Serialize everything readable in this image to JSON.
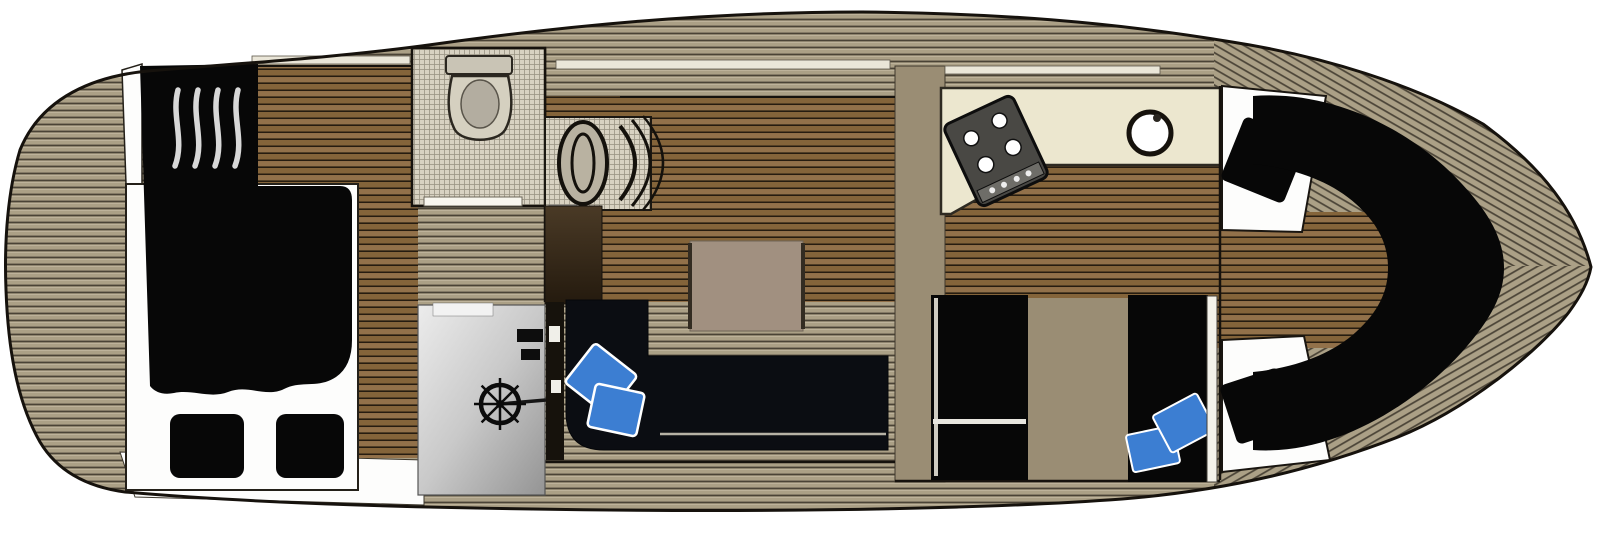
{
  "diagram": {
    "type": "boat-floorplan-top-view",
    "bow_direction": "right",
    "areas": [
      {
        "id": "stern-deck",
        "label": "stern side deck"
      },
      {
        "id": "aft-cabin",
        "label": "aft cabin double berth"
      },
      {
        "id": "companionway-steps",
        "label": "companionway steps"
      },
      {
        "id": "head",
        "label": "head bathroom with toilet"
      },
      {
        "id": "helm-seat",
        "label": "helm seat"
      },
      {
        "id": "helm-console",
        "label": "helm console with steering wheel"
      },
      {
        "id": "salon",
        "label": "salon with table"
      },
      {
        "id": "settee",
        "label": "L-shaped settee with blue pillows"
      },
      {
        "id": "galley",
        "label": "galley with 4-burner stove and round sink"
      },
      {
        "id": "corridor",
        "label": "passageway"
      },
      {
        "id": "wardrobe",
        "label": "wardrobe locker"
      },
      {
        "id": "mid-berth",
        "label": "mid cabin berth with blue pillows"
      },
      {
        "id": "v-berth",
        "label": "bow V-berth with black pillows"
      }
    ],
    "colors": {
      "outline": "#16120d",
      "deck_base": "#aba086",
      "deck_line": "#4a4336",
      "wood_base": "#85653b",
      "wood_line": "#261c10",
      "tile_base": "#d8d2c2",
      "tile_line": "#9a9484",
      "counter_cream": "#ece7cf",
      "corridor_tan": "#9a8d74",
      "table_top": "#a19080",
      "upholstery_black": "#070707",
      "sofa_black": "#0b0d12",
      "pillow_blue": "#3c7ed2",
      "bedding_white": "#fdfdfc",
      "stove_gray": "#494844",
      "window_light": "#eae6d8",
      "panel_light": "#ececec",
      "panel_dark": "#949494"
    }
  }
}
